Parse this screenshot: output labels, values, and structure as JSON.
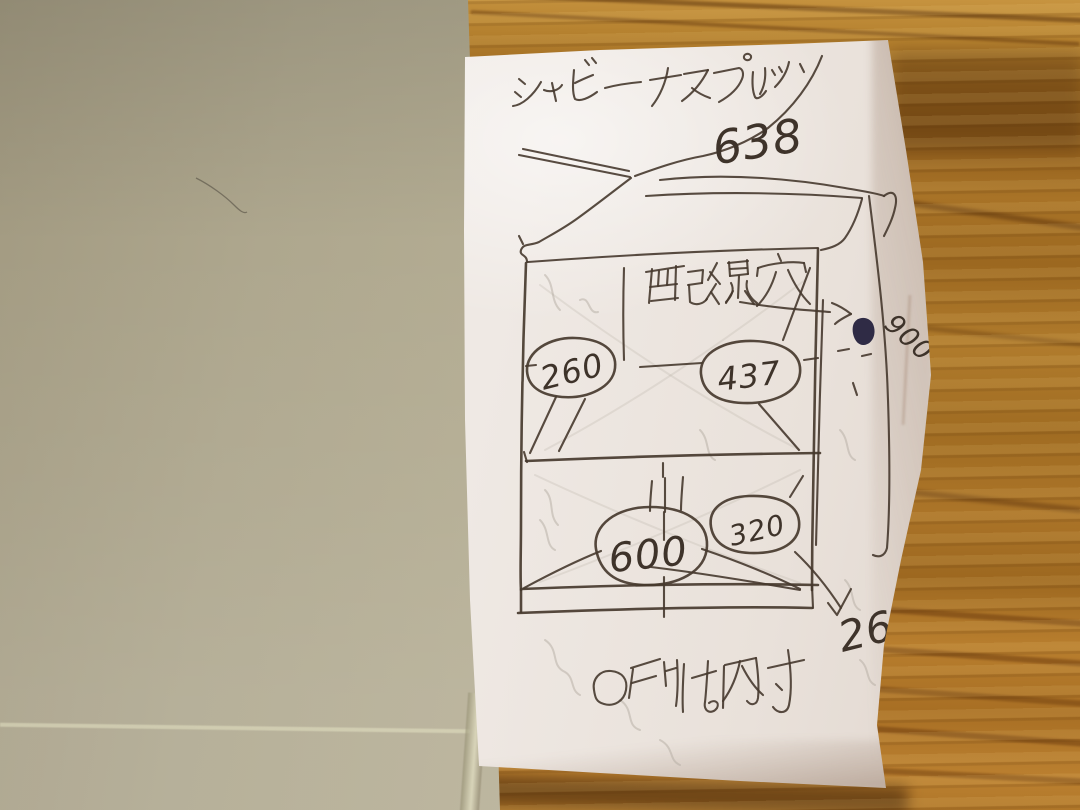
{
  "memo": {
    "title": "シャビーエスプレッソ",
    "top_width": "638",
    "wiring_hole_label": "配線穴",
    "circled_inner_dimensions": {
      "upper_left": "260",
      "upper_right": "437",
      "lower_center": "600",
      "lower_right": "320"
    },
    "overall_height": "900",
    "bottom_right_dimension": "267",
    "footnote_mark": "○",
    "footnote_text": "印は内寸"
  }
}
